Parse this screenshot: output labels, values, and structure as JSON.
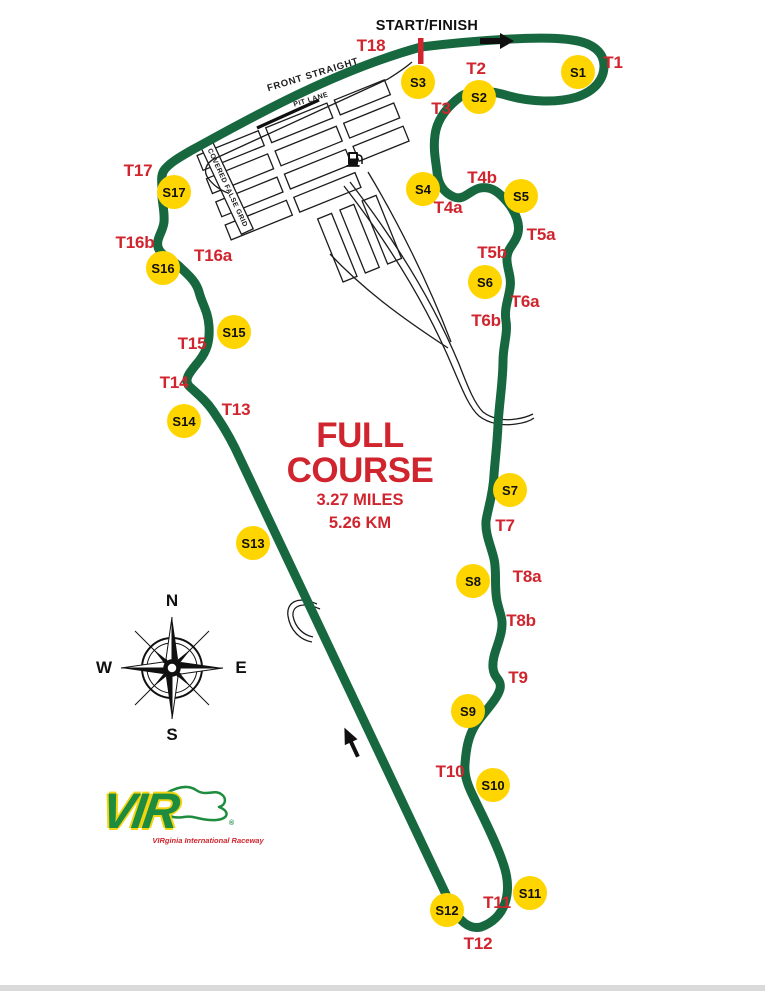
{
  "colors": {
    "track_green": "#17683f",
    "label_red": "#d0252e",
    "station_yellow": "#FFD500",
    "logo_green": "#1e8c3e",
    "logo_yellow": "#f2d410"
  },
  "course": {
    "line1": "FULL",
    "line2": "COURSE",
    "miles": "3.27 MILES",
    "km": "5.26 KM"
  },
  "start_finish": {
    "label": "START/FINISH"
  },
  "labels": {
    "front_straight": "FRONT STRAIGHT",
    "pit_lane": "PIT LANE",
    "covered_grid": "COVERED FALSE GRID"
  },
  "compass": {
    "n": "N",
    "s": "S",
    "e": "E",
    "w": "W"
  },
  "logo": {
    "text": "VIR",
    "reg": "®",
    "tagline": "VIRginia International Raceway"
  },
  "turns": [
    {
      "label": "T1",
      "x": 613,
      "y": 63
    },
    {
      "label": "T2",
      "x": 476,
      "y": 69
    },
    {
      "label": "T3",
      "x": 441,
      "y": 109
    },
    {
      "label": "T4a",
      "x": 448,
      "y": 208
    },
    {
      "label": "T4b",
      "x": 482,
      "y": 178
    },
    {
      "label": "T5a",
      "x": 541,
      "y": 235
    },
    {
      "label": "T5b",
      "x": 492,
      "y": 253
    },
    {
      "label": "T6a",
      "x": 525,
      "y": 302
    },
    {
      "label": "T6b",
      "x": 486,
      "y": 321
    },
    {
      "label": "T7",
      "x": 505,
      "y": 526
    },
    {
      "label": "T8a",
      "x": 527,
      "y": 577
    },
    {
      "label": "T8b",
      "x": 521,
      "y": 621
    },
    {
      "label": "T9",
      "x": 518,
      "y": 678
    },
    {
      "label": "T10",
      "x": 450,
      "y": 772
    },
    {
      "label": "T11",
      "x": 497,
      "y": 903
    },
    {
      "label": "T12",
      "x": 478,
      "y": 944
    },
    {
      "label": "T13",
      "x": 236,
      "y": 410
    },
    {
      "label": "T14",
      "x": 174,
      "y": 383
    },
    {
      "label": "T15",
      "x": 192,
      "y": 344
    },
    {
      "label": "T16a",
      "x": 213,
      "y": 256
    },
    {
      "label": "T16b",
      "x": 135,
      "y": 243
    },
    {
      "label": "T17",
      "x": 138,
      "y": 171
    },
    {
      "label": "T18",
      "x": 371,
      "y": 46
    }
  ],
  "stations": [
    {
      "label": "S1",
      "x": 578,
      "y": 72
    },
    {
      "label": "S2",
      "x": 479,
      "y": 97
    },
    {
      "label": "S3",
      "x": 418,
      "y": 82
    },
    {
      "label": "S4",
      "x": 423,
      "y": 189
    },
    {
      "label": "S5",
      "x": 521,
      "y": 196
    },
    {
      "label": "S6",
      "x": 485,
      "y": 282
    },
    {
      "label": "S7",
      "x": 510,
      "y": 490
    },
    {
      "label": "S8",
      "x": 473,
      "y": 581
    },
    {
      "label": "S9",
      "x": 468,
      "y": 711
    },
    {
      "label": "S10",
      "x": 493,
      "y": 785
    },
    {
      "label": "S11",
      "x": 530,
      "y": 893
    },
    {
      "label": "S12",
      "x": 447,
      "y": 910
    },
    {
      "label": "S13",
      "x": 253,
      "y": 543
    },
    {
      "label": "S14",
      "x": 184,
      "y": 421
    },
    {
      "label": "S15",
      "x": 234,
      "y": 332
    },
    {
      "label": "S16",
      "x": 163,
      "y": 268
    },
    {
      "label": "S17",
      "x": 174,
      "y": 192
    }
  ]
}
